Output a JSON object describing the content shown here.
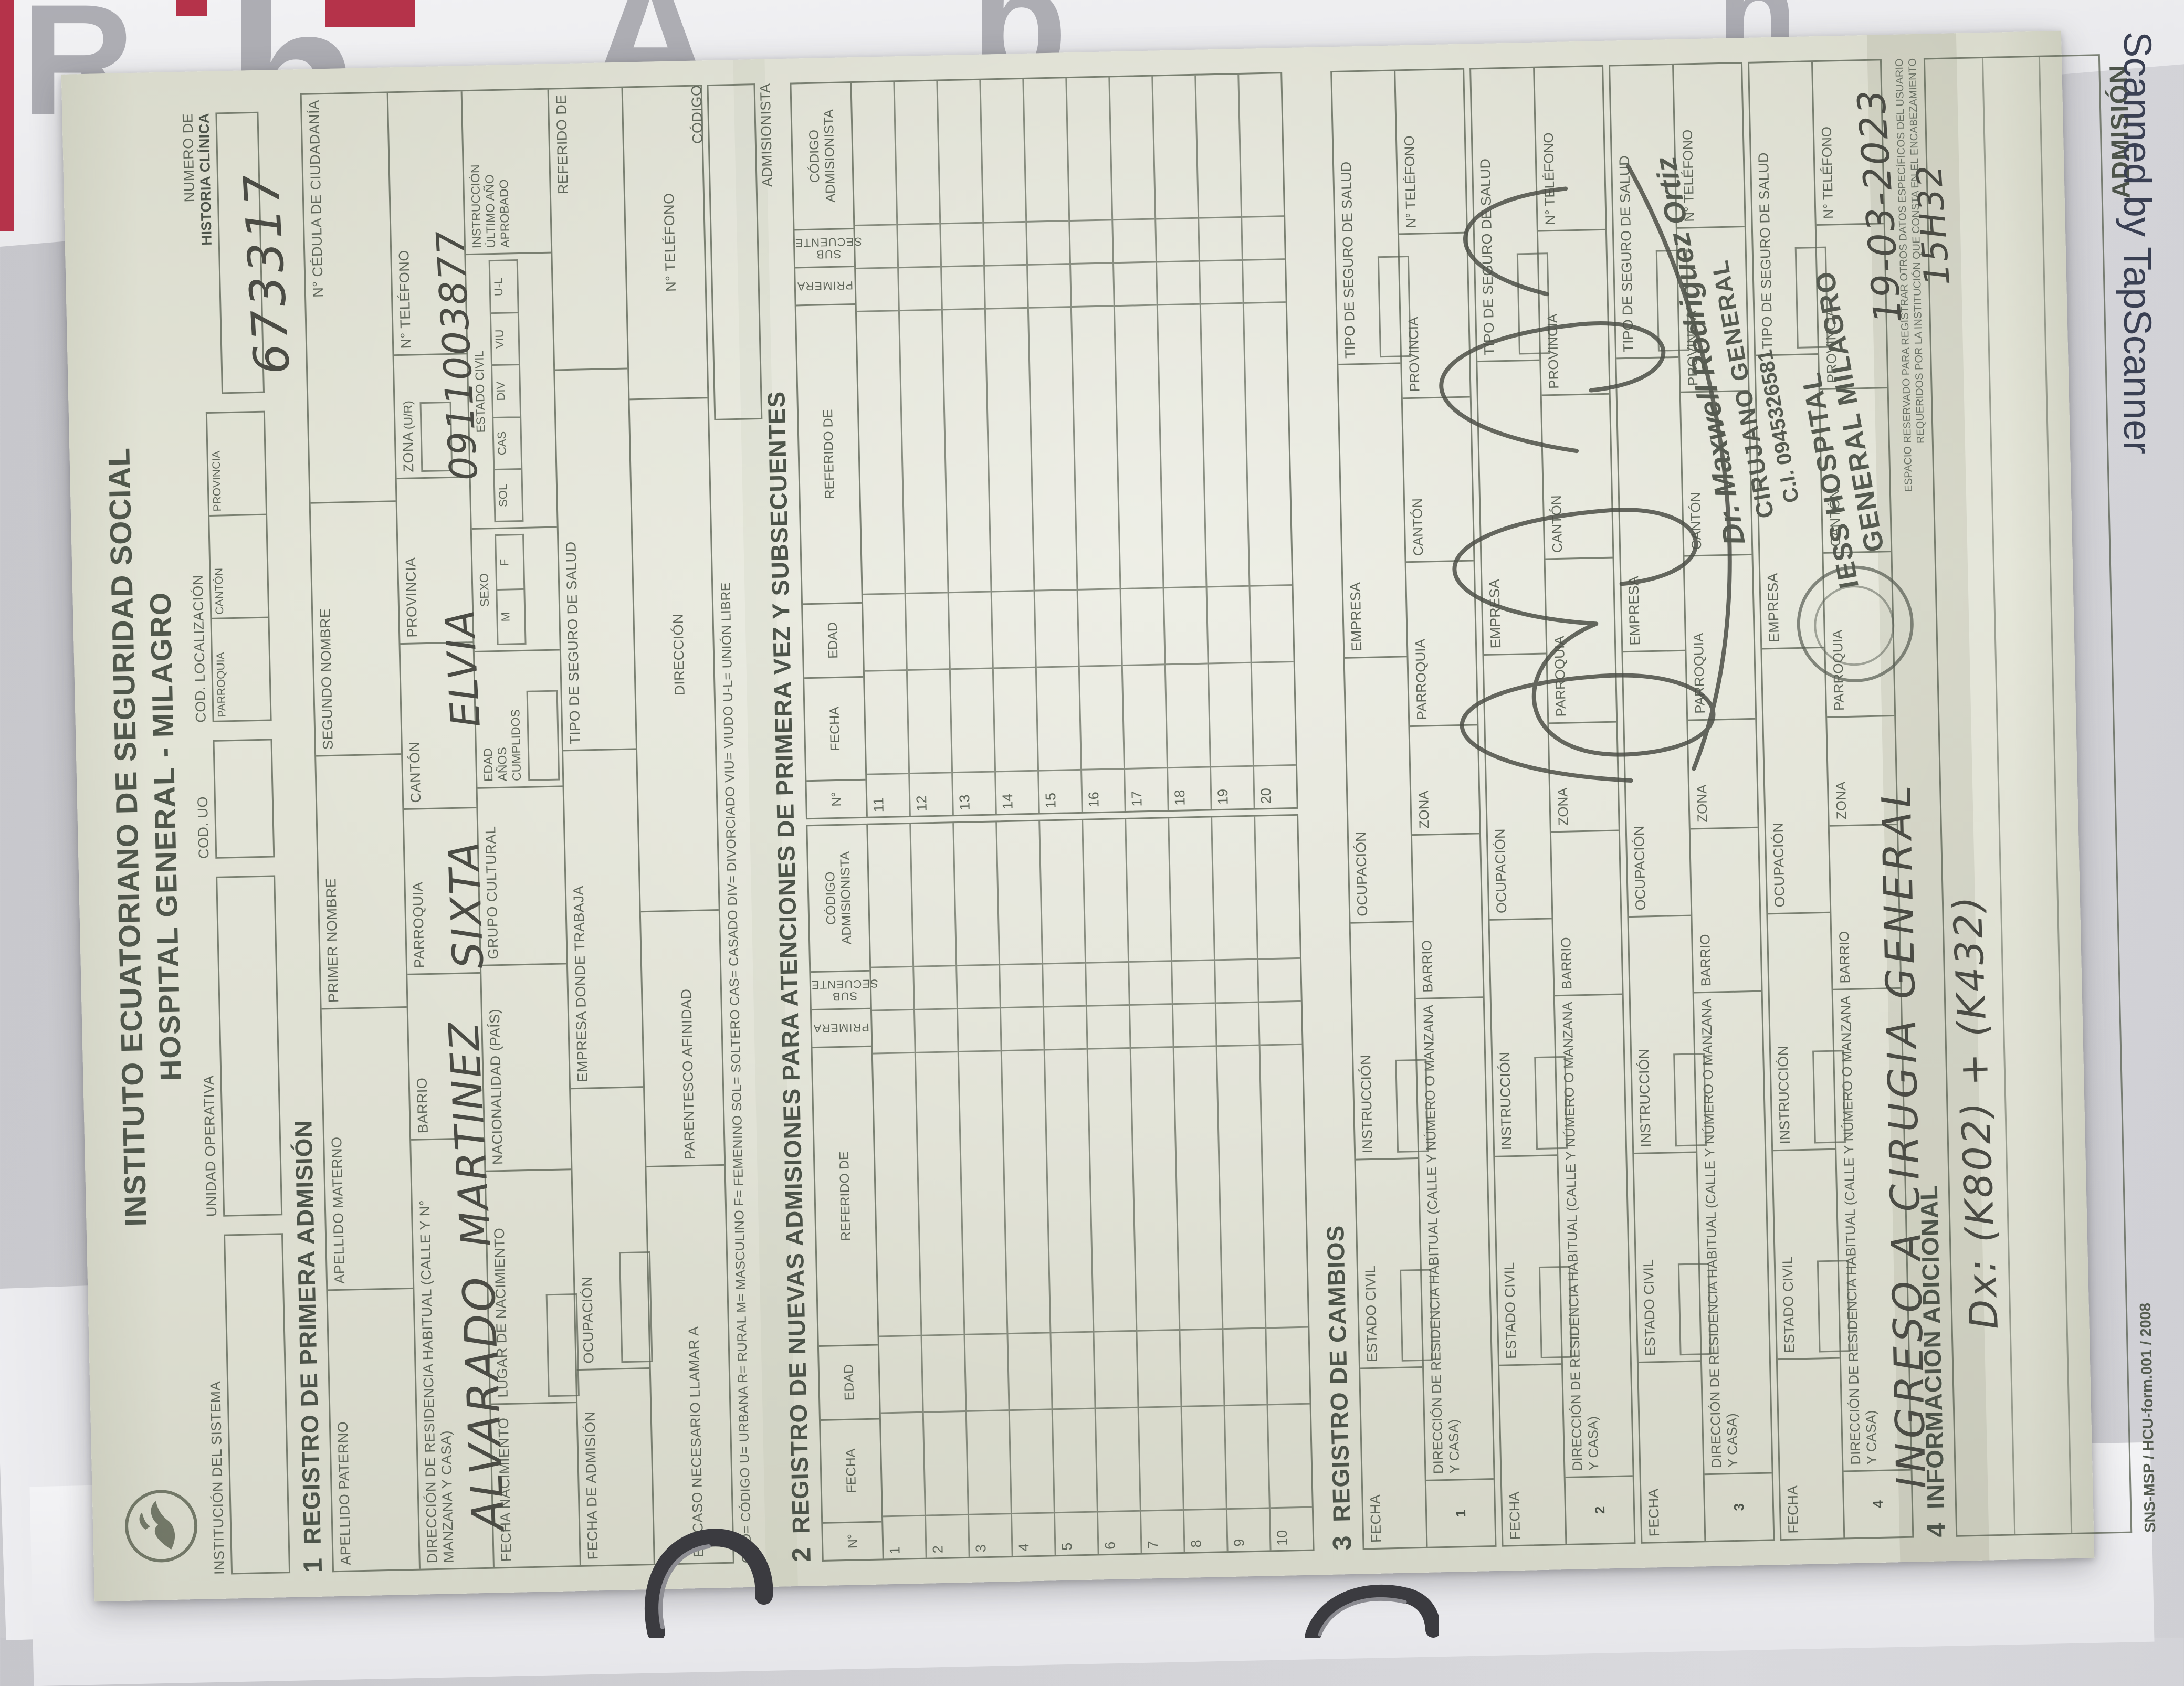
{
  "photo": {
    "watermark": "Scanned by TapScanner",
    "poster_glyphs": [
      "R",
      "h",
      "A",
      "b",
      "h"
    ]
  },
  "colors": {
    "paper": "#e0e1d4",
    "ink": "#5f665a",
    "handwriting": "#4b4c45",
    "stamp_ink": "#565b51",
    "watermark": "#3a4053",
    "poster_red": "#b5334a"
  },
  "form": {
    "title_line1": "INSTITUTO ECUATORIANO DE SEGURIDAD SOCIAL",
    "title_line2": "HOSPITAL GENERAL - MILAGRO",
    "header": {
      "institucion_label": "INSTITUCIÓN DEL SISTEMA",
      "unidad_label": "UNIDAD OPERATIVA",
      "cod_uo_label": "COD. UO",
      "cod_loc_label": "COD. LOCALIZACIÓN",
      "parroquia": "PARROQUIA",
      "canton": "CANTÓN",
      "provincia": "PROVINCIA",
      "historia_label_1": "NUMERO DE",
      "historia_label_2": "HISTORIA CLÍNICA",
      "historia_value": "673317"
    },
    "section1": {
      "num": "1",
      "heading": "REGISTRO DE PRIMERA ADMISIÓN",
      "apellido_paterno": "APELLIDO PATERNO",
      "apellido_paterno_value": "ALVARADO",
      "apellido_materno": "APELLIDO MATERNO",
      "apellido_materno_value": "MARTINEZ",
      "primer_nombre": "PRIMER NOMBRE",
      "primer_nombre_value": "SIXTA",
      "segundo_nombre": "SEGUNDO NOMBRE",
      "segundo_nombre_value": "ELVIA",
      "cedula_label": "N° CÉDULA DE CIUDADANÍA",
      "cedula_value": "0911003877",
      "direccion_label": "DIRECCIÓN DE RESIDENCIA HABITUAL   (CALLE Y N°  MANZANA Y CASA)",
      "barrio": "BARRIO",
      "parroquia": "PARROQUIA",
      "canton": "CANTÓN",
      "provincia": "PROVINCIA",
      "zona": "ZONA",
      "zona_sub": "(U/R)",
      "telefono": "N° TELÉFONO",
      "fecha_nacimiento": "FECHA NACIMIENTO",
      "lugar_nacimiento": "LUGAR DE NACIMIENTO",
      "nacionalidad": "NACIONALIDAD (PAÍS)",
      "grupo_cultural": "GRUPO CULTURAL",
      "edad_l1": "EDAD",
      "edad_l2": "AÑOS",
      "edad_l3": "CUMPLIDOS",
      "sexo": "SEXO",
      "sexo_m": "M",
      "sexo_f": "F",
      "estado_civil": "ESTADO CIVIL",
      "ec_sol": "SOL",
      "ec_cas": "CAS",
      "ec_div": "DIV",
      "ec_viu": "VIU",
      "ec_ul": "U-L",
      "instruccion_l1": "INSTRUCCIÓN",
      "instruccion_l2": "ÚLTIMO AÑO",
      "instruccion_l3": "APROBADO",
      "fecha_admision": "FECHA DE ADMISIÓN",
      "ocupacion": "OCUPACIÓN",
      "empresa_trabaja": "EMPRESA DONDE TRABAJA",
      "tipo_seguro": "TIPO DE SEGURO DE SALUD",
      "referido_de": "REFERIDO DE",
      "llamar_a": "EN CASO NECESARIO LLAMAR A",
      "parentesco": "PARENTESCO  AFINIDAD",
      "direccion2": "DIRECCIÓN",
      "telefono2": "N° TELÉFONO",
      "codigo": "CÓDIGO",
      "admisionista": "ADMISIONISTA",
      "legend": "COD= CÓDIGO    U= URBANA    R= RURAL    M= MASCULINO    F= FEMENINO    SOL= SOLTERO    CAS= CASADO    DIV= DIVORCIADO    VIU= VIUDO    U-L= UNIÓN LIBRE"
    },
    "section2": {
      "num": "2",
      "heading": "REGISTRO DE NUEVAS ADMISIONES PARA ATENCIONES DE PRIMERA VEZ Y SUBSECUENTES",
      "col_n": "N°",
      "col_fecha": "FECHA",
      "col_edad": "EDAD",
      "col_referido": "REFERIDO DE",
      "col_primera": "PRIMERA",
      "col_subsecuente": "SUB SECUENTE",
      "col_codigo_l1": "CÓDIGO",
      "col_codigo_l2": "ADMISIONISTA",
      "rows_left": [
        "1",
        "2",
        "3",
        "4",
        "5",
        "6",
        "7",
        "8",
        "9",
        "10"
      ],
      "rows_right": [
        "11",
        "12",
        "13",
        "14",
        "15",
        "16",
        "17",
        "18",
        "19",
        "20"
      ]
    },
    "section3": {
      "num": "3",
      "heading": "REGISTRO DE CAMBIOS",
      "fecha": "FECHA",
      "estado_civil": "ESTADO CIVIL",
      "instruccion": "INSTRUCCIÓN",
      "ocupacion": "OCUPACIÓN",
      "empresa": "EMPRESA",
      "tipo_seguro": "TIPO DE SEGURO DE SALUD",
      "direccion": "DIRECCIÓN DE RESIDENCIA HABITUAL   (CALLE Y NÚMERO O MANZANA Y CASA)",
      "barrio": "BARRIO",
      "zona": "ZONA",
      "parroquia": "PARROQUIA",
      "canton": "CANTÓN",
      "provincia": "PROVINCIA",
      "telefono": "N° TELÉFONO",
      "blocks": [
        "1",
        "2",
        "3",
        "4"
      ]
    },
    "section4": {
      "num": "4",
      "heading": "INFORMACIÓN ADICIONAL",
      "fine_print_1": "ESPACIO RESERVADO PARA REGISTRAR OTROS DATOS ESPECÍFICOS DEL USUARIO",
      "fine_print_2": "REQUERIDOS POR LA INSTITUCIÓN QUE CONSTA EN EL ENCABEZAMIENTO",
      "hw_line1": "INGRESO A CIRUGIA GENERAL",
      "hw_date": "19-03-2023",
      "hw_time": "15H32",
      "hw_dx": "Dx: (K802) + (K432)"
    },
    "stamp": {
      "doctor": "Dr. Maxwell Rodriguez Ortiz",
      "role": "CIRUJANO GENERAL",
      "ci": "C.I. 0945326581",
      "hospital_l1": "IESS HOSPITAL",
      "hospital_l2": "GENERAL MILAGRO"
    },
    "footer": {
      "left": "SNS-MSP / HCU-form.001 / 2008",
      "right": "ADMISIÓN"
    }
  }
}
